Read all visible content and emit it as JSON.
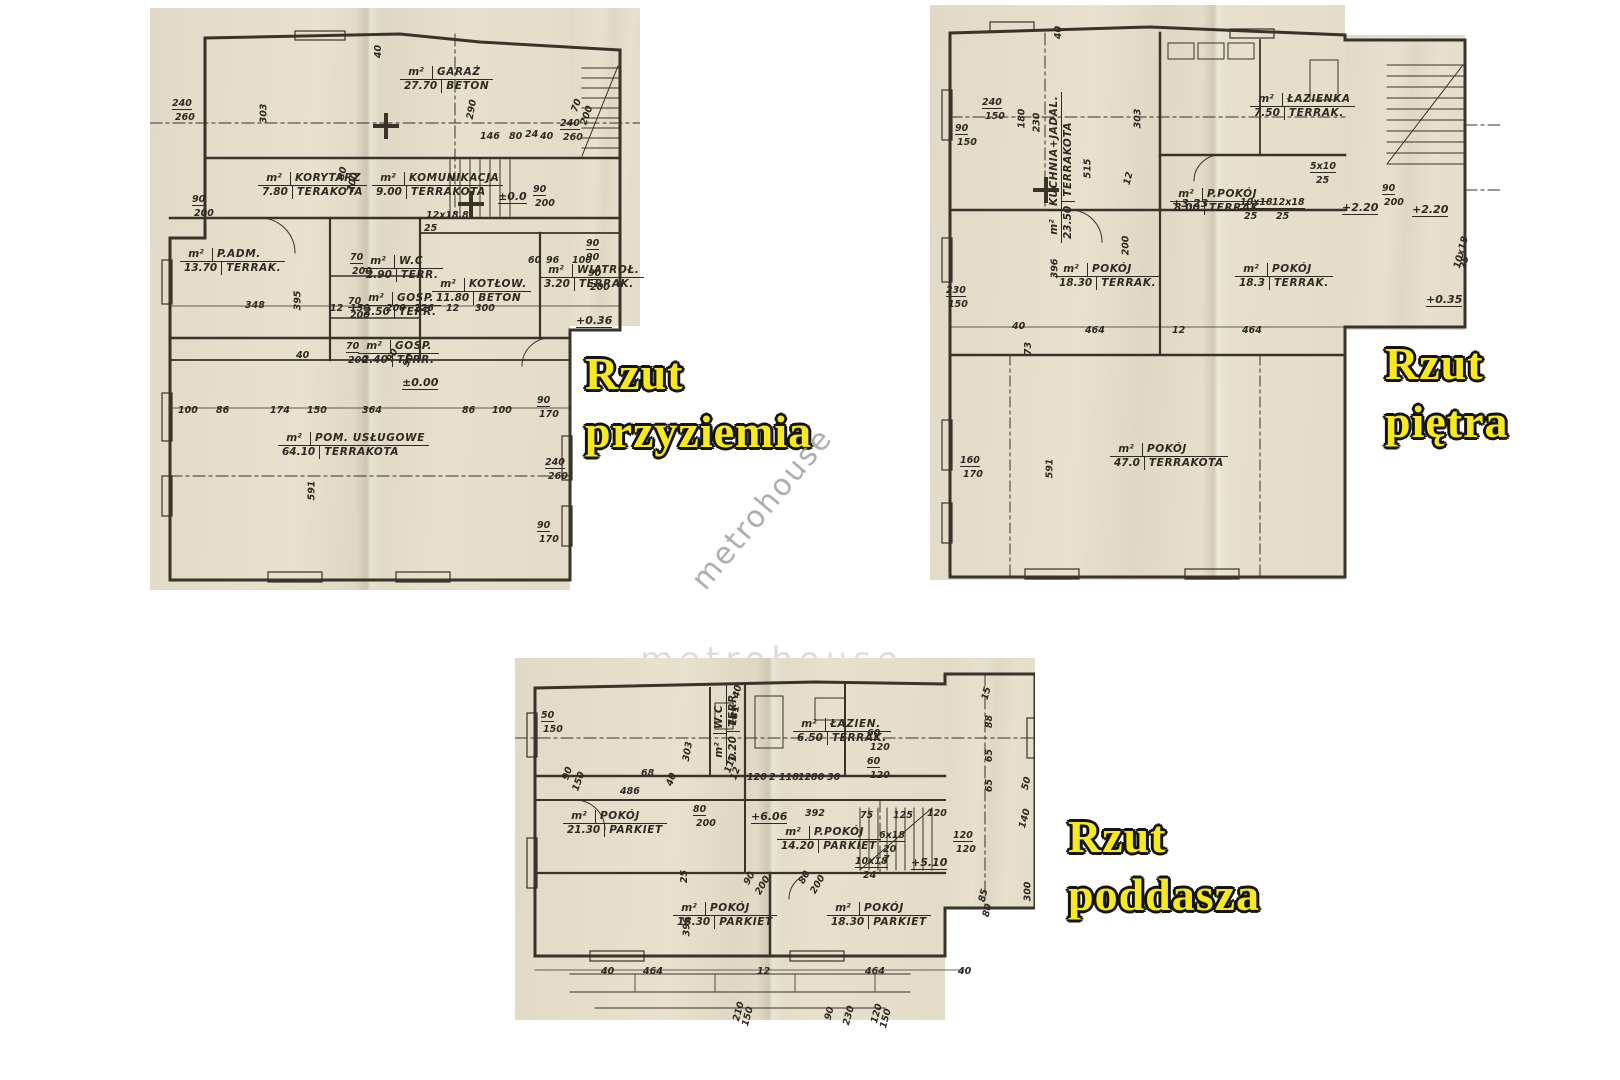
{
  "watermark": {
    "text": "metrohouse"
  },
  "unit_label": "m²",
  "plan_titles": {
    "przyziemie": {
      "line1": "Rzut",
      "line2": "przyziemia"
    },
    "pietro": {
      "line1": "Rzut",
      "line2": "piętra"
    },
    "poddasze": {
      "line1": "Rzut",
      "line2": "poddasza"
    }
  },
  "plans": {
    "przyziemie": {
      "rooms": [
        {
          "name": "GARAŻ",
          "area": "27.70",
          "floor": "BETON",
          "x": 250,
          "y": 58
        },
        {
          "name": "KORYTARZ",
          "area": "7.80",
          "floor": "TERAKOTA",
          "x": 108,
          "y": 164
        },
        {
          "name": "KOMUNIKACJA",
          "area": "9.00",
          "floor": "TERRAKOTA",
          "x": 222,
          "y": 164
        },
        {
          "name": "P.ADM.",
          "area": "13.70",
          "floor": "TERRAK.",
          "x": 30,
          "y": 240
        },
        {
          "name": "W.C",
          "area": "2.90",
          "floor": "TERR.",
          "x": 212,
          "y": 247
        },
        {
          "name": "GOSP.",
          "area": "2.50",
          "floor": "TERR.",
          "x": 210,
          "y": 284
        },
        {
          "name": "GOSP.",
          "area": "2.40",
          "floor": "TERR.",
          "x": 208,
          "y": 332
        },
        {
          "name": "KOTŁOW.",
          "area": "11.80",
          "floor": "BETON",
          "x": 282,
          "y": 270
        },
        {
          "name": "WIATROŁ.",
          "area": "3.20",
          "floor": "TERRAK.",
          "x": 390,
          "y": 256
        },
        {
          "name": "POM. USŁUGOWE",
          "area": "64.10",
          "floor": "TERRAKOTA",
          "x": 128,
          "y": 424
        }
      ],
      "dims": [
        {
          "t": "40",
          "x": 222,
          "y": 38,
          "r": -90
        },
        {
          "t": "240",
          "x": 22,
          "y": 90,
          "u": 1
        },
        {
          "t": "260",
          "x": 25,
          "y": 104
        },
        {
          "t": "303",
          "x": 104,
          "y": 100,
          "r": -90
        },
        {
          "t": "290",
          "x": 312,
          "y": 96,
          "r": -80
        },
        {
          "t": "146",
          "x": 330,
          "y": 123
        },
        {
          "t": "80",
          "x": 359,
          "y": 123
        },
        {
          "t": "24",
          "x": 375,
          "y": 121
        },
        {
          "t": "40",
          "x": 390,
          "y": 123
        },
        {
          "t": "240",
          "x": 410,
          "y": 110,
          "u": 1
        },
        {
          "t": "260",
          "x": 413,
          "y": 124
        },
        {
          "t": "70",
          "x": 420,
          "y": 92,
          "r": -70
        },
        {
          "t": "200",
          "x": 427,
          "y": 102,
          "r": -70
        },
        {
          "t": "90",
          "x": 42,
          "y": 186,
          "u": 1
        },
        {
          "t": "200",
          "x": 44,
          "y": 200
        },
        {
          "t": "80",
          "x": 186,
          "y": 160,
          "r": -75
        },
        {
          "t": "200",
          "x": 193,
          "y": 169,
          "r": -75
        },
        {
          "t": "±0.0",
          "x": 348,
          "y": 182,
          "lvl": 1
        },
        {
          "t": "12x18.8",
          "x": 276,
          "y": 202
        },
        {
          "t": "25",
          "x": 274,
          "y": 215
        },
        {
          "t": "90",
          "x": 383,
          "y": 176,
          "u": 1
        },
        {
          "t": "200",
          "x": 385,
          "y": 190
        },
        {
          "t": "90",
          "x": 436,
          "y": 230,
          "u": 1
        },
        {
          "t": "90",
          "x": 436,
          "y": 244
        },
        {
          "t": "70",
          "x": 200,
          "y": 244,
          "u": 1
        },
        {
          "t": "200",
          "x": 202,
          "y": 258
        },
        {
          "t": "70",
          "x": 198,
          "y": 288,
          "u": 1
        },
        {
          "t": "200",
          "x": 200,
          "y": 302
        },
        {
          "t": "70",
          "x": 196,
          "y": 333,
          "u": 1
        },
        {
          "t": "200",
          "x": 198,
          "y": 347
        },
        {
          "t": "60",
          "x": 378,
          "y": 247
        },
        {
          "t": "96",
          "x": 396,
          "y": 247
        },
        {
          "t": "100",
          "x": 422,
          "y": 247
        },
        {
          "t": "90",
          "x": 438,
          "y": 260,
          "u": 1
        },
        {
          "t": "200",
          "x": 440,
          "y": 274
        },
        {
          "t": "348",
          "x": 95,
          "y": 292
        },
        {
          "t": "395",
          "x": 138,
          "y": 287,
          "r": -90
        },
        {
          "t": "12",
          "x": 180,
          "y": 295
        },
        {
          "t": "150",
          "x": 200,
          "y": 295
        },
        {
          "t": "200",
          "x": 236,
          "y": 295
        },
        {
          "t": "226",
          "x": 264,
          "y": 295
        },
        {
          "t": "12",
          "x": 296,
          "y": 295
        },
        {
          "t": "300",
          "x": 325,
          "y": 295
        },
        {
          "t": "+0.36",
          "x": 426,
          "y": 306,
          "lvl": 1
        },
        {
          "t": "40",
          "x": 146,
          "y": 342
        },
        {
          "t": "90",
          "x": 236,
          "y": 342,
          "r": -60
        },
        {
          "t": "90",
          "x": 252,
          "y": 347,
          "r": -60
        },
        {
          "t": "±0.00",
          "x": 252,
          "y": 368,
          "lvl": 1
        },
        {
          "t": "100",
          "x": 28,
          "y": 397
        },
        {
          "t": "86",
          "x": 66,
          "y": 397
        },
        {
          "t": "174",
          "x": 120,
          "y": 397
        },
        {
          "t": "150",
          "x": 157,
          "y": 397
        },
        {
          "t": "364",
          "x": 212,
          "y": 397
        },
        {
          "t": "86",
          "x": 312,
          "y": 397
        },
        {
          "t": "100",
          "x": 342,
          "y": 397
        },
        {
          "t": "90",
          "x": 387,
          "y": 387,
          "u": 1
        },
        {
          "t": "170",
          "x": 389,
          "y": 401
        },
        {
          "t": "591",
          "x": 152,
          "y": 477,
          "r": -90
        },
        {
          "t": "240",
          "x": 395,
          "y": 449,
          "u": 1
        },
        {
          "t": "260",
          "x": 398,
          "y": 463
        },
        {
          "t": "90",
          "x": 387,
          "y": 512,
          "u": 1
        },
        {
          "t": "170",
          "x": 389,
          "y": 526
        }
      ]
    },
    "pietro": {
      "rooms": [
        {
          "name": "KUCHNIA+JADAL.",
          "area": "23.50",
          "floor": "TERRAKOTA",
          "x": 118,
          "y": 238,
          "r": -90
        },
        {
          "name": "ŁAZIENKA",
          "area": "7.50",
          "floor": "TERRAK.",
          "x": 320,
          "y": 88
        },
        {
          "name": "P.POKÓJ",
          "area": "8.00",
          "floor": "TERRAK.",
          "x": 240,
          "y": 183
        },
        {
          "name": "POKÓJ",
          "area": "18.30",
          "floor": "TERRAK.",
          "x": 125,
          "y": 258
        },
        {
          "name": "POKÓJ",
          "area": "18.3",
          "floor": "TERRAK.",
          "x": 305,
          "y": 258
        },
        {
          "name": "POKÓJ",
          "area": "47.0",
          "floor": "TERRAKOTA",
          "x": 180,
          "y": 438
        }
      ],
      "dims": [
        {
          "t": "40",
          "x": 122,
          "y": 22,
          "r": -90
        },
        {
          "t": "240",
          "x": 52,
          "y": 92,
          "u": 1
        },
        {
          "t": "150",
          "x": 55,
          "y": 106
        },
        {
          "t": "90",
          "x": 25,
          "y": 118,
          "u": 1
        },
        {
          "t": "150",
          "x": 27,
          "y": 132
        },
        {
          "t": "180",
          "x": 82,
          "y": 108,
          "r": -90
        },
        {
          "t": "230",
          "x": 97,
          "y": 112,
          "r": -90
        },
        {
          "t": "515",
          "x": 148,
          "y": 158,
          "r": -90
        },
        {
          "t": "303",
          "x": 198,
          "y": 108,
          "r": -90
        },
        {
          "t": "12",
          "x": 192,
          "y": 168,
          "r": -75
        },
        {
          "t": "200",
          "x": 186,
          "y": 235,
          "r": -90
        },
        {
          "t": "+3.23",
          "x": 242,
          "y": 192,
          "lvl": 1
        },
        {
          "t": "5x10",
          "x": 380,
          "y": 156,
          "u": 1
        },
        {
          "t": "25",
          "x": 386,
          "y": 170
        },
        {
          "t": "10x18",
          "x": 310,
          "y": 192,
          "u": 1
        },
        {
          "t": "25",
          "x": 314,
          "y": 206
        },
        {
          "t": "12x18",
          "x": 342,
          "y": 192,
          "u": 1
        },
        {
          "t": "25",
          "x": 346,
          "y": 206
        },
        {
          "t": "+2.20",
          "x": 412,
          "y": 196,
          "lvl": 1
        },
        {
          "t": "90",
          "x": 452,
          "y": 178,
          "u": 1
        },
        {
          "t": "200",
          "x": 454,
          "y": 192
        },
        {
          "t": "+2.20",
          "x": 482,
          "y": 198,
          "lvl": 1
        },
        {
          "t": "10x18",
          "x": 515,
          "y": 242,
          "r": -75
        },
        {
          "t": "25",
          "x": 528,
          "y": 252,
          "r": -75
        },
        {
          "t": "+0.35",
          "x": 496,
          "y": 288,
          "lvl": 1
        },
        {
          "t": "230",
          "x": 16,
          "y": 280,
          "u": 1
        },
        {
          "t": "150",
          "x": 18,
          "y": 294
        },
        {
          "t": "396",
          "x": 115,
          "y": 258,
          "r": -90
        },
        {
          "t": "464",
          "x": 155,
          "y": 320
        },
        {
          "t": "12",
          "x": 242,
          "y": 320
        },
        {
          "t": "464",
          "x": 312,
          "y": 320
        },
        {
          "t": "40",
          "x": 82,
          "y": 316
        },
        {
          "t": "73",
          "x": 92,
          "y": 338,
          "r": -90
        },
        {
          "t": "160",
          "x": 30,
          "y": 450,
          "u": 1
        },
        {
          "t": "170",
          "x": 33,
          "y": 464
        },
        {
          "t": "591",
          "x": 110,
          "y": 458,
          "r": -90
        }
      ]
    },
    "poddasze": {
      "rooms": [
        {
          "name": "W.C",
          "area": "1.20",
          "floor": "TERR.",
          "x": 198,
          "y": 108,
          "r": -90
        },
        {
          "name": "ŁAZIEN.",
          "area": "6.50",
          "floor": "TERRAK.",
          "x": 278,
          "y": 60
        },
        {
          "name": "POKÓJ",
          "area": "21.30",
          "floor": "PARKIET",
          "x": 48,
          "y": 152
        },
        {
          "name": "P.POKÓJ",
          "area": "14.20",
          "floor": "PARKIET",
          "x": 262,
          "y": 168
        },
        {
          "name": "POKÓJ",
          "area": "18.30",
          "floor": "PARKIET",
          "x": 158,
          "y": 244
        },
        {
          "name": "POKÓJ",
          "area": "18.30",
          "floor": "PARKIET",
          "x": 312,
          "y": 244
        }
      ],
      "dims": [
        {
          "t": "50",
          "x": 26,
          "y": 52,
          "u": 1
        },
        {
          "t": "150",
          "x": 28,
          "y": 66
        },
        {
          "t": "90",
          "x": 46,
          "y": 110,
          "r": -70
        },
        {
          "t": "150",
          "x": 54,
          "y": 118,
          "r": -70
        },
        {
          "t": "68",
          "x": 126,
          "y": 110
        },
        {
          "t": "40",
          "x": 150,
          "y": 116,
          "r": -70
        },
        {
          "t": "303",
          "x": 163,
          "y": 88,
          "r": -80
        },
        {
          "t": "181",
          "x": 210,
          "y": 52,
          "r": -80
        },
        {
          "t": "40",
          "x": 216,
          "y": 28,
          "r": -80
        },
        {
          "t": "110",
          "x": 206,
          "y": 100,
          "r": -70
        },
        {
          "t": "12",
          "x": 214,
          "y": 110,
          "r": -70
        },
        {
          "t": "120",
          "x": 232,
          "y": 114
        },
        {
          "t": "2",
          "x": 254,
          "y": 114
        },
        {
          "t": "118",
          "x": 264,
          "y": 114
        },
        {
          "t": "12",
          "x": 283,
          "y": 114
        },
        {
          "t": "80",
          "x": 296,
          "y": 114
        },
        {
          "t": "30",
          "x": 312,
          "y": 114
        },
        {
          "t": "60",
          "x": 352,
          "y": 70,
          "u": 1
        },
        {
          "t": "120",
          "x": 355,
          "y": 84
        },
        {
          "t": "60",
          "x": 352,
          "y": 98,
          "u": 1
        },
        {
          "t": "120",
          "x": 355,
          "y": 112
        },
        {
          "t": "15",
          "x": 465,
          "y": 30,
          "r": -75
        },
        {
          "t": "88",
          "x": 468,
          "y": 58,
          "r": -90
        },
        {
          "t": "65",
          "x": 468,
          "y": 92,
          "r": -90
        },
        {
          "t": "65",
          "x": 468,
          "y": 122,
          "r": -90
        },
        {
          "t": "50",
          "x": 505,
          "y": 120,
          "r": -75
        },
        {
          "t": "140",
          "x": 500,
          "y": 155,
          "r": -75
        },
        {
          "t": "120",
          "x": 438,
          "y": 172,
          "u": 1
        },
        {
          "t": "120",
          "x": 441,
          "y": 186
        },
        {
          "t": "300",
          "x": 503,
          "y": 228,
          "r": -90
        },
        {
          "t": "85",
          "x": 462,
          "y": 232,
          "r": -75
        },
        {
          "t": "80",
          "x": 466,
          "y": 247,
          "r": -75
        },
        {
          "t": "486",
          "x": 105,
          "y": 128
        },
        {
          "t": "80",
          "x": 178,
          "y": 146,
          "u": 1
        },
        {
          "t": "200",
          "x": 181,
          "y": 160
        },
        {
          "t": "+6.06",
          "x": 236,
          "y": 152,
          "lvl": 1
        },
        {
          "t": "392",
          "x": 290,
          "y": 150
        },
        {
          "t": "75",
          "x": 345,
          "y": 152
        },
        {
          "t": "125",
          "x": 378,
          "y": 152
        },
        {
          "t": "120",
          "x": 412,
          "y": 150
        },
        {
          "t": "6x18",
          "x": 364,
          "y": 172,
          "u": 1
        },
        {
          "t": "20",
          "x": 368,
          "y": 186
        },
        {
          "t": "10x18",
          "x": 340,
          "y": 198,
          "u": 1
        },
        {
          "t": "7",
          "x": 368,
          "y": 196
        },
        {
          "t": "24",
          "x": 348,
          "y": 212
        },
        {
          "t": "+5.10",
          "x": 396,
          "y": 198,
          "lvl": 1
        },
        {
          "t": "25",
          "x": 163,
          "y": 213,
          "r": -90
        },
        {
          "t": "396",
          "x": 162,
          "y": 263,
          "r": -90
        },
        {
          "t": "90",
          "x": 228,
          "y": 215,
          "r": -60
        },
        {
          "t": "200",
          "x": 238,
          "y": 222,
          "r": -60
        },
        {
          "t": "80",
          "x": 283,
          "y": 214,
          "r": -60
        },
        {
          "t": "200",
          "x": 293,
          "y": 221,
          "r": -60
        },
        {
          "t": "40",
          "x": 86,
          "y": 308
        },
        {
          "t": "464",
          "x": 128,
          "y": 308
        },
        {
          "t": "12",
          "x": 242,
          "y": 308
        },
        {
          "t": "464",
          "x": 350,
          "y": 308
        },
        {
          "t": "40",
          "x": 443,
          "y": 308
        },
        {
          "t": "210",
          "x": 214,
          "y": 348,
          "r": -75
        },
        {
          "t": "150",
          "x": 223,
          "y": 353,
          "r": -75
        },
        {
          "t": "90",
          "x": 308,
          "y": 350,
          "r": -75
        },
        {
          "t": "230",
          "x": 324,
          "y": 352,
          "r": -75
        },
        {
          "t": "120",
          "x": 352,
          "y": 350,
          "r": -75
        },
        {
          "t": "150",
          "x": 361,
          "y": 355,
          "r": -75
        }
      ]
    }
  }
}
